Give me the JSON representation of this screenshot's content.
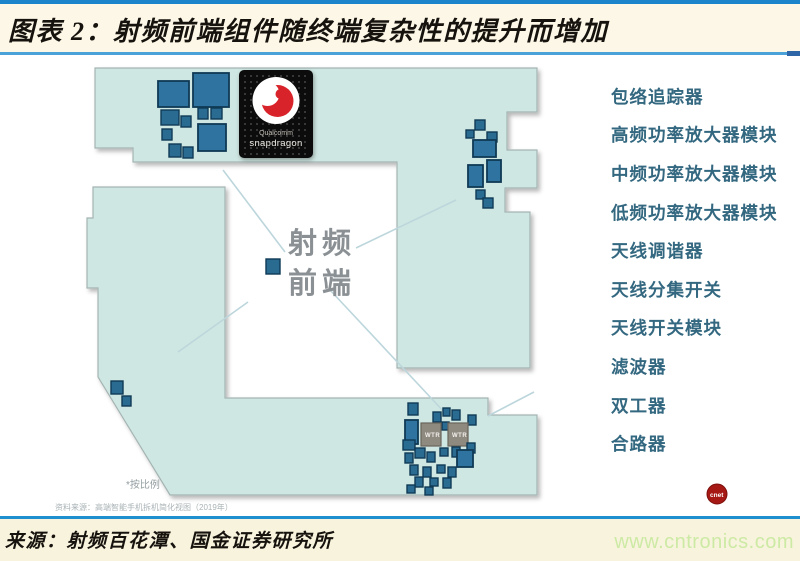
{
  "header": {
    "title": "图表 2：射频前端组件随终端复杂性的提升而增加"
  },
  "diagram": {
    "rf_label": {
      "line1": "射频",
      "line2": "前端"
    },
    "chip": {
      "line1": "Qualcomm",
      "line2": "snapdragon"
    },
    "wtr_label": "WTR",
    "badge": "cnet",
    "scale_note": "*按比例",
    "caption": "资料来源：高端智能手机拆机简化视图（2019年）",
    "components": [
      "包络追踪器",
      "高频功率放大器模块",
      "中频功率放大器模块",
      "低频功率放大器模块",
      "天线调谐器",
      "天线分集开关",
      "天线开关模块",
      "滤波器",
      "双工器",
      "合路器"
    ]
  },
  "footer": {
    "source": "来源：射频百花潭、国金证券研究所",
    "url": "www.cntronics.com"
  },
  "colors": {
    "top_rule": "#1b84cb",
    "title_rule": "#4ba2d8",
    "bottom_rule": "#1e8fcf",
    "band_cream": "#fdf7e7",
    "board_fill": "#cfe7e2",
    "component_blue": "#2a6b92",
    "list_text": "#336880",
    "url_green": "#cdeaa5",
    "badge_red": "#a51814"
  }
}
